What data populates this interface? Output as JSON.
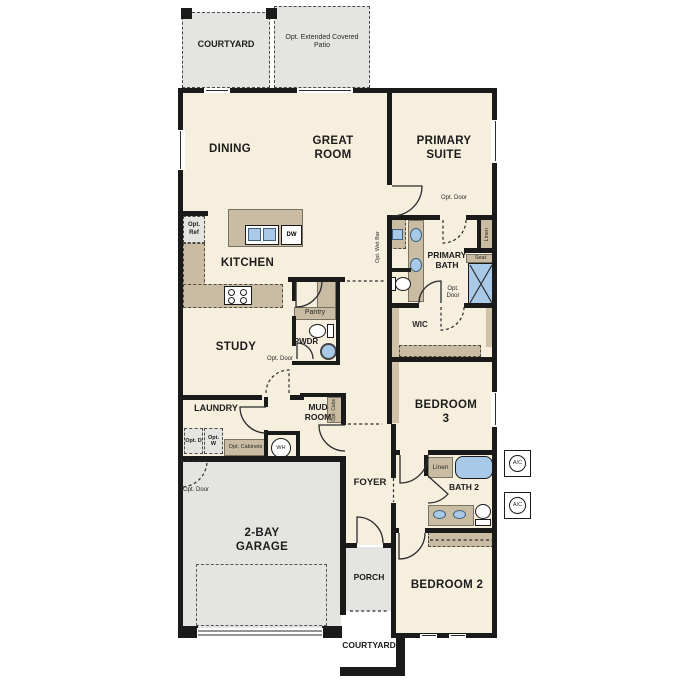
{
  "plan": {
    "rooms": {
      "dining": "DINING",
      "great_room": "GREAT ROOM",
      "primary_suite": "PRIMARY SUITE",
      "kitchen": "KITCHEN",
      "primary_bath": "PRIMARY BATH",
      "wic": "WIC",
      "study": "STUDY",
      "pwdr": "PWDR",
      "laundry": "LAUNDRY",
      "mud_room": "MUD ROOM",
      "bedroom3": "BEDROOM 3",
      "foyer": "FOYER",
      "bath2": "BATH 2",
      "bedroom2": "BEDROOM 2",
      "garage": "2-BAY GARAGE",
      "porch": "PORCH"
    },
    "outdoor": {
      "courtyard_top": "COURTYARD",
      "patio": "Opt. Extended Covered Patio",
      "courtyard_bottom": "COURTYARD"
    },
    "labels": {
      "opt_ref": "Opt. Ref",
      "dw": "DW",
      "pantry": "Pantry",
      "opt_wet_bar": "Opt. Wet Bar",
      "opt_door": "Opt. Door",
      "linen": "Linen",
      "seat": "Seat",
      "opt_cabs": "Opt. Cabs",
      "opt_d": "Opt. D",
      "opt_w": "Opt. W",
      "opt_cabinets": "Opt. Cabinets",
      "wh": "WH",
      "ac": "A/C"
    },
    "colors": {
      "wall": "#1a1a1a",
      "room": "#f7efde",
      "outdoor": "#e4e4e1",
      "cabinet": "#cabca3",
      "fixture": "#a9c9e9"
    }
  }
}
